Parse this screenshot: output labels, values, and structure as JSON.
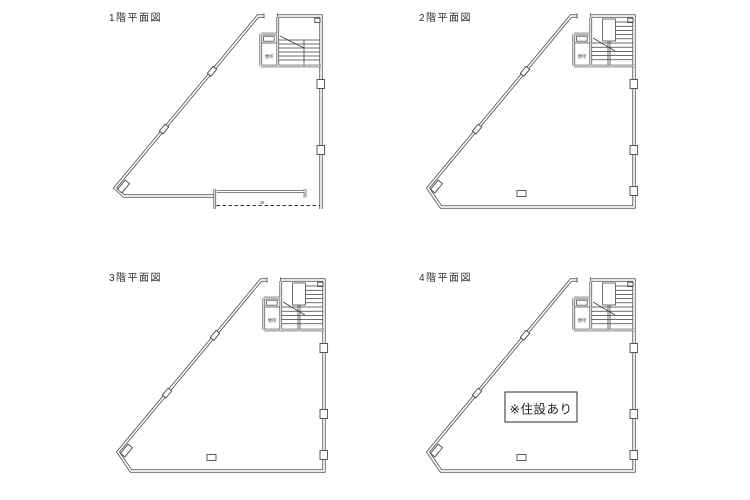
{
  "sheet": {
    "background": "#ffffff",
    "line_color": "#3f3f3f"
  },
  "plans": [
    {
      "title": "1階平面図",
      "stair_room_label": "便所",
      "shutter_note": "45"
    },
    {
      "title": "2階平面図",
      "stair_room_label": "便所"
    },
    {
      "title": "3階平面図",
      "stair_room_label": "便所"
    },
    {
      "title": "4階平面図",
      "stair_room_label": "便所",
      "annotation": "※住設あり"
    }
  ]
}
